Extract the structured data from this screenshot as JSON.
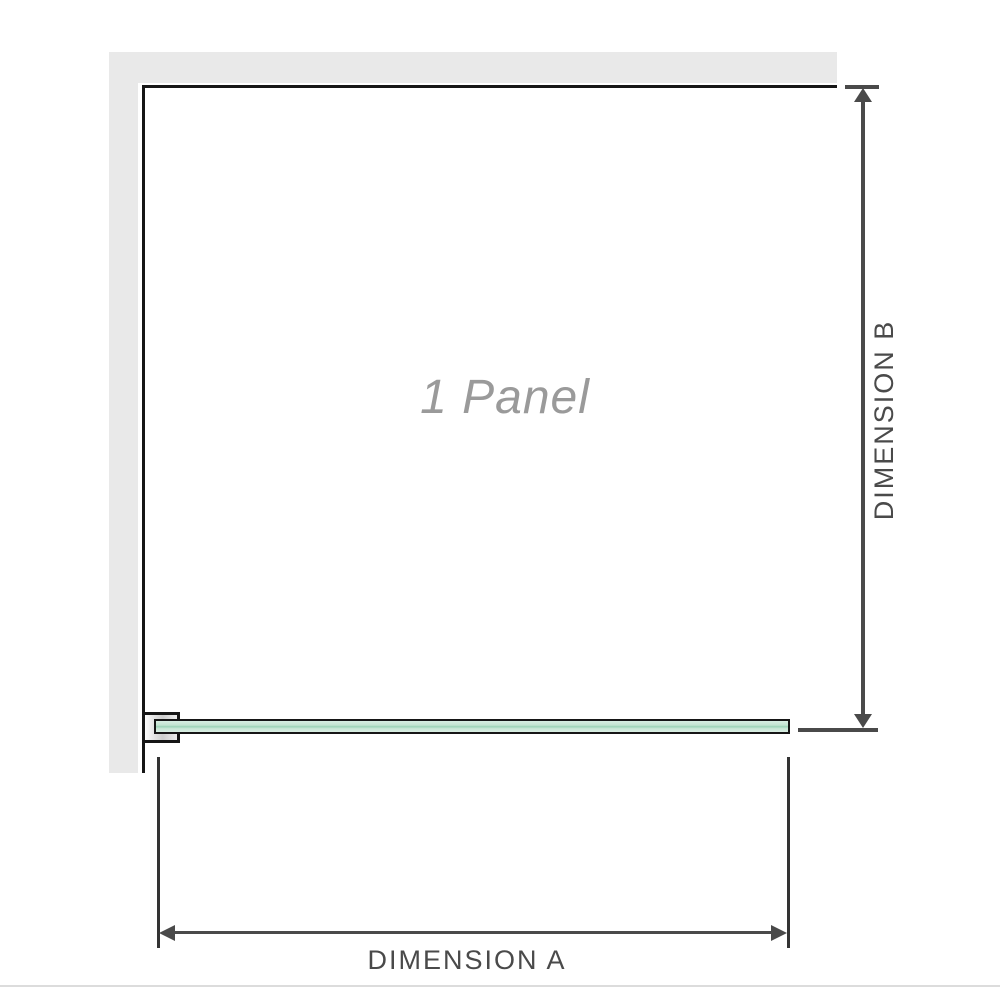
{
  "diagram": {
    "panel_label": "1 Panel",
    "dimension_a_label": "DIMENSION A",
    "dimension_b_label": "DIMENSION B"
  },
  "colors": {
    "wall": "#e9e9e9",
    "outline": "#161616",
    "dimension_line": "#4a4a4a",
    "glass_light": "#d9eee3",
    "glass_mid": "#9cd3b7",
    "label_gray": "#9a9a9a",
    "separator": "#dcdcdc"
  }
}
